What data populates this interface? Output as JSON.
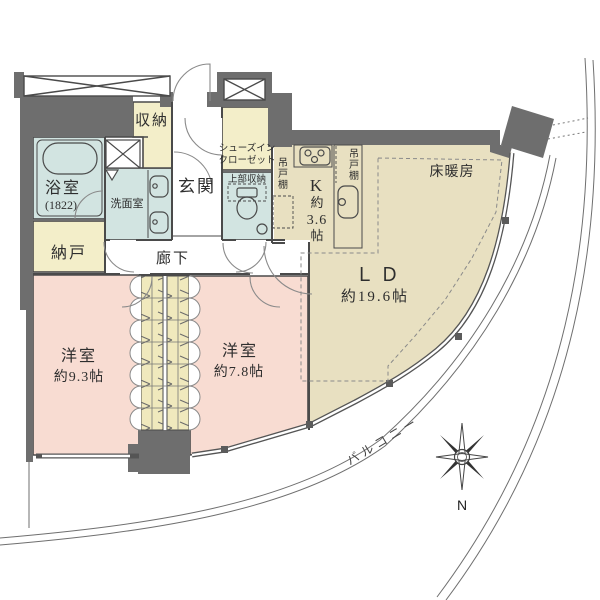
{
  "colors": {
    "wall": "#6e6e6e",
    "water_room": "#d2e4e1",
    "closet_cream": "#f3eec9",
    "floor_tan": "#e8e0c1",
    "bedroom_pink": "#f8dcd2",
    "line": "#4a4a4a"
  },
  "rooms": {
    "bathroom": {
      "name": "浴室",
      "dim": "(1822)"
    },
    "storage": {
      "name": "収納"
    },
    "washroom": {
      "name": "洗面室"
    },
    "entrance": {
      "name": "玄関"
    },
    "shoes_closet": {
      "line1": "シューズイン",
      "line2": "クローゼット"
    },
    "upper_storage": {
      "name": "上部収納"
    },
    "cupboard_left": {
      "name": "吊戸棚"
    },
    "cupboard_right": {
      "name": "吊戸棚"
    },
    "kitchen": {
      "l1": "K",
      "l2": "約",
      "l3": "3.6",
      "l4": "帖"
    },
    "floor_heating": {
      "name": "床暖房"
    },
    "living_dining": {
      "name": "ＬＤ",
      "size": "約19.6帖"
    },
    "closet": {
      "name": "納戸"
    },
    "corridor": {
      "name": "廊下"
    },
    "bedroom_a": {
      "name": "洋室",
      "size": "約9.3帖"
    },
    "bedroom_b": {
      "name": "洋室",
      "size": "約7.8帖"
    },
    "balcony": {
      "name": "バルコニー"
    }
  },
  "compass": {
    "north": "N"
  }
}
